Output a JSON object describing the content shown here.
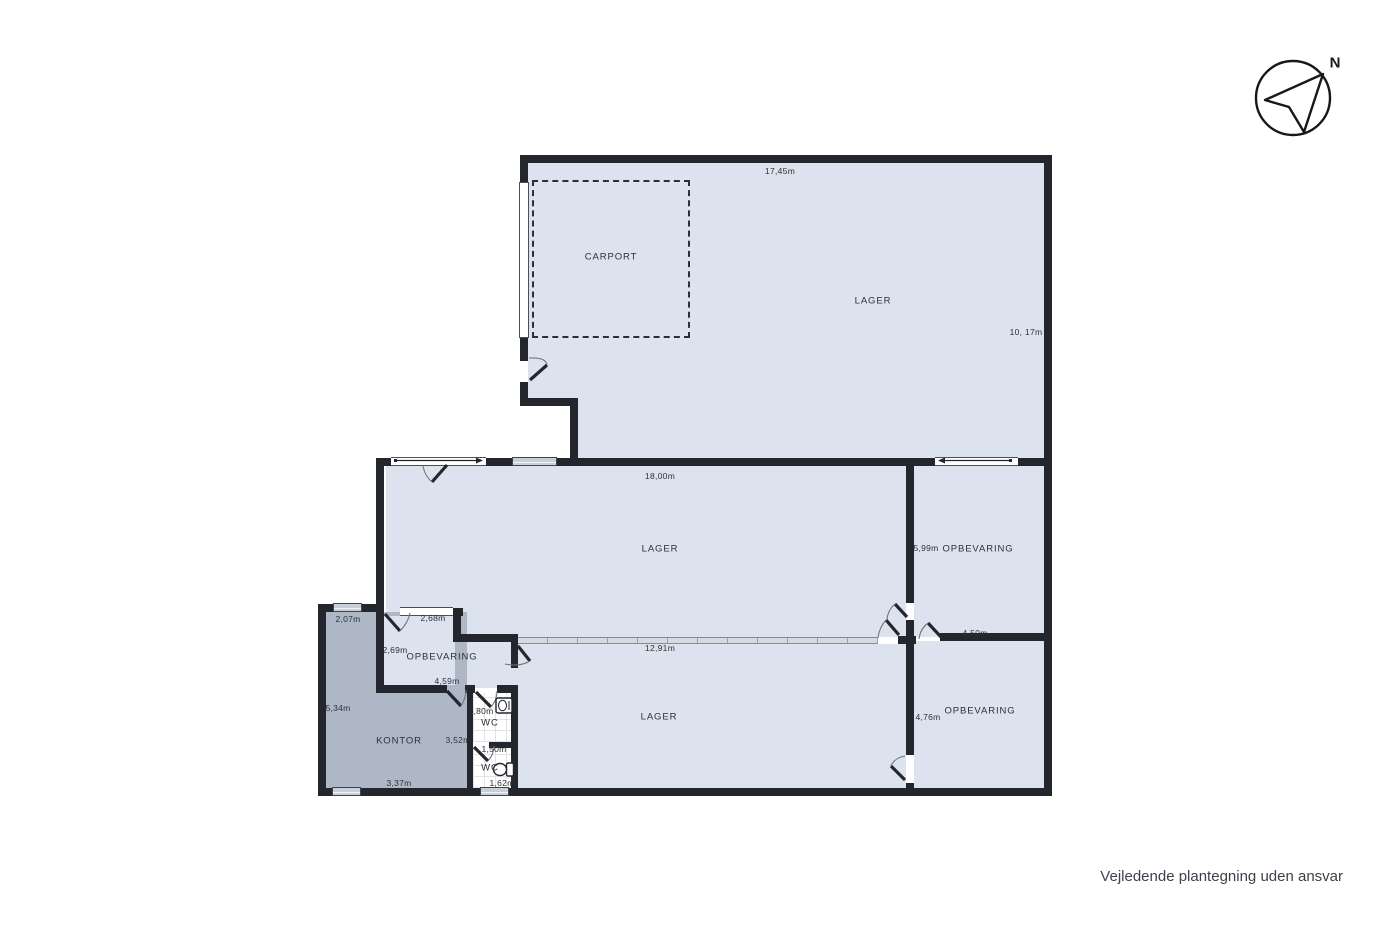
{
  "title": "Floor plan",
  "rooms": {
    "carport": "CARPORT",
    "lager_top": "LAGER",
    "lager_mid": "LAGER",
    "lager_bottom": "LAGER",
    "opbevaring_ne": "OPBEVARING",
    "opbevaring_se": "OPBEVARING",
    "opbevaring_w": "OPBEVARING",
    "kontor": "KONTOR",
    "wc_top": "WC",
    "wc_bottom": "WC"
  },
  "dims": {
    "lager_top_w": "17,45m",
    "lager_top_h": "10, 17m",
    "lager_mid_w": "18,00m",
    "opb_ne_h": "5,99m",
    "opb_se_w": "4,50m",
    "opb_se_h": "4,76m",
    "opb_w_top": "2,68m",
    "opb_w_left": "2,69m",
    "opb_w_bottom": "4,59m",
    "kontor_top": "2,07m",
    "kontor_left": "5,34m",
    "kontor_bottom": "3,37m",
    "kontor_right": "3,52m",
    "wc_top_w": "1,80m",
    "wc_divider": "1,50m",
    "wc_bottom_w": "1,62m",
    "partition": "12,91m"
  },
  "compass": {
    "north": "N"
  },
  "footer": {
    "disclaimer": "Vejledende plantegning uden ansvar"
  },
  "colors": {
    "wall": "#23262d",
    "floor": "#dde3ee",
    "kontor": "#aeb7c6",
    "partition": "#d7dbe1",
    "text": "#2b3038"
  }
}
